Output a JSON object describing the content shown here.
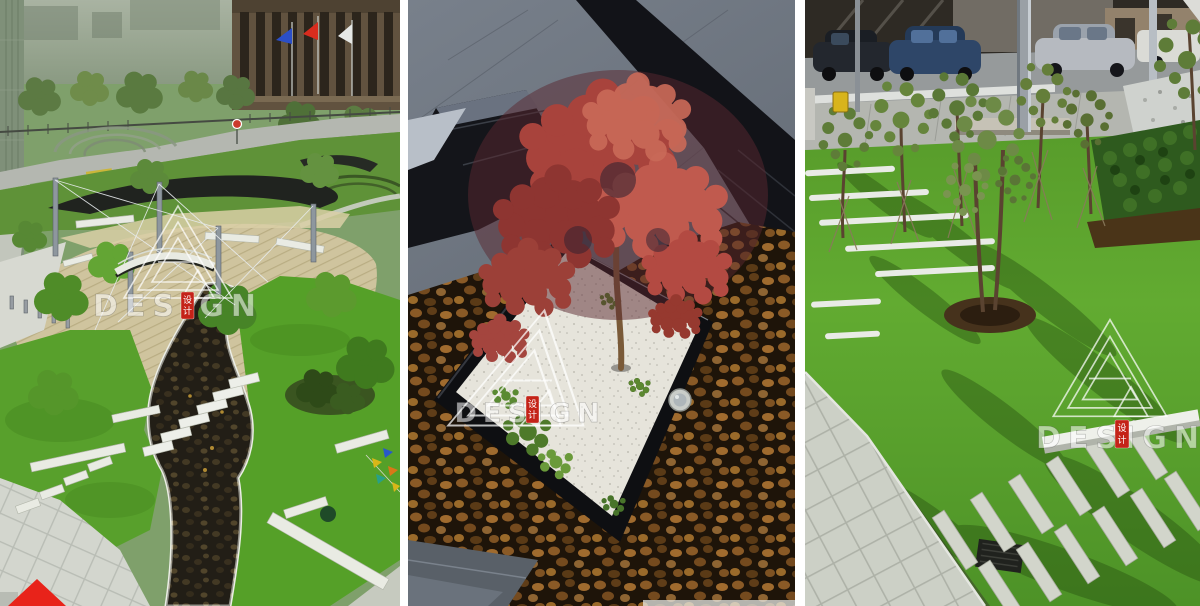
{
  "image": {
    "kind": "landscape-architecture photo triptych",
    "width_px": 1200,
    "height_px": 606,
    "panel_count": 3
  },
  "watermark": {
    "text": "DESIGN",
    "seal_chars": [
      "设",
      "计"
    ],
    "logo": "nested-triangle-A-monogram",
    "text_color": "rgba(255,255,255,0.55)",
    "seal_color": "#c42318"
  },
  "panels": [
    {
      "name": "aerial-park-plaza",
      "subject": "aerial park plaza with steel pylons, cable bridge, wood deck, winding pebble stream, stepping stones, lawns"
    },
    {
      "name": "red-maple-planter",
      "subject": "red japanese maple in square white-gravel planter with black rim set in brown pebble pool"
    },
    {
      "name": "lawn-paver-garden",
      "subject": "young staked trees, white paver strips and stone bench in lawn beside parking lot with cars"
    }
  ],
  "corner_marker": {
    "shape": "red-triangle",
    "color": "#e8231a"
  },
  "palette": {
    "gutter_white": "#ffffff",
    "lawn_green": "#5ca22c",
    "deck_tan": "#cfc49e",
    "slate_gray": "#6d7480",
    "pebble_brown": "#8a5a26",
    "gravel_white": "#e6e4db",
    "maple_red": "#b04840",
    "asphalt_gray": "#969a9b",
    "black_stone": "#141518"
  }
}
